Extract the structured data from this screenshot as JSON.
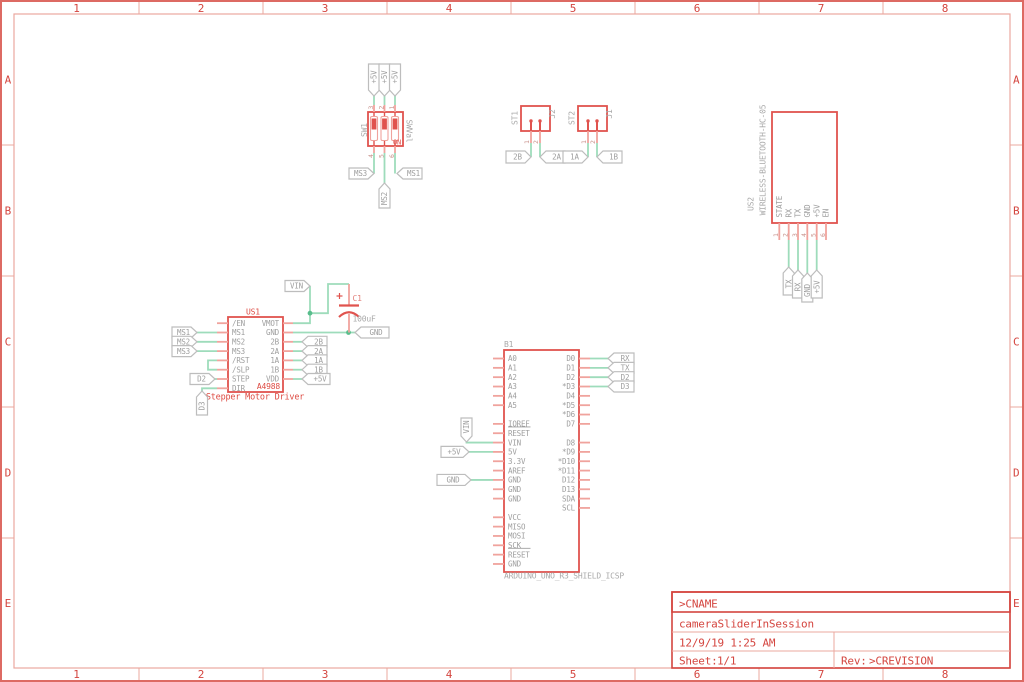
{
  "sheet": {
    "columns": [
      "1",
      "2",
      "3",
      "4",
      "5",
      "6",
      "7",
      "8"
    ],
    "rows": [
      "A",
      "B",
      "C",
      "D",
      "E"
    ]
  },
  "title_block": {
    "cname": ">CNAME",
    "project": "cameraSliderInSession",
    "datetime": "12/9/19 1:25 AM",
    "sheet_label": "Sheet:",
    "sheet_number": "1/1",
    "rev_label": "Rev:",
    "rev_value": ">CREVISION"
  },
  "dip_switch": {
    "name": "SW1",
    "value": "SWVal",
    "on_label": "ON",
    "top_pin_numbers": [
      "3",
      "2",
      "1"
    ],
    "bottom_pin_numbers": [
      "4",
      "5",
      "6"
    ],
    "top_flags": [
      "+5V",
      "+5V",
      "+5V"
    ],
    "bottom_flags": [
      "MS3",
      "MS2",
      "MS1"
    ]
  },
  "screw_terminal_1": {
    "name": "ST1",
    "value": "J2",
    "pin_numbers": [
      "1",
      "2"
    ],
    "flags": [
      "2B",
      "2A"
    ]
  },
  "screw_terminal_2": {
    "name": "ST2",
    "value": "J1",
    "pin_numbers": [
      "1",
      "2"
    ],
    "flags": [
      "1A",
      "1B"
    ]
  },
  "bluetooth": {
    "name": "US2",
    "value": "WIRELESS-BLUETOOTH-HC-05",
    "pins": [
      "STATE",
      "RX",
      "TX",
      "GND",
      "+5V",
      "EN"
    ],
    "pin_numbers": [
      "1",
      "2",
      "3",
      "4",
      "5",
      "6"
    ],
    "flags": [
      "TX",
      "RX",
      "GND",
      "+5V"
    ]
  },
  "stepper_driver": {
    "name": "US1",
    "value": "A4988",
    "caption": "Stepper Motor Driver",
    "pin_rows": [
      {
        "left": "/EN",
        "right": "VMOT"
      },
      {
        "left": "MS1",
        "right": "GND"
      },
      {
        "left": "MS2",
        "right": "2B"
      },
      {
        "left": "MS3",
        "right": "2A"
      },
      {
        "left": "/RST",
        "right": "1A"
      },
      {
        "left": "/SLP",
        "right": "1B"
      },
      {
        "left": "STEP",
        "right": "VDD"
      },
      {
        "left": "DIR",
        "right": ""
      }
    ],
    "left_flags": [
      "MS1",
      "MS2",
      "MS3"
    ],
    "step_flag": "D2",
    "dir_flag": "D3",
    "vin_flag": "VIN",
    "gnd_flag": "GND",
    "right_flags": [
      "2B",
      "2A",
      "1A",
      "1B",
      "+5V"
    ]
  },
  "capacitor": {
    "name": "C1",
    "value": "100uF",
    "polarity": "+"
  },
  "arduino": {
    "name": "B1",
    "value": "ARDUINO_UNO_R3_SHIELD_ICSP",
    "pin_rows": [
      {
        "left": "A0",
        "right": "D0"
      },
      {
        "left": "A1",
        "right": "D1"
      },
      {
        "left": "A2",
        "right": "D2"
      },
      {
        "left": "A3",
        "right": "*D3"
      },
      {
        "left": "A4",
        "right": "D4"
      },
      {
        "left": "A5",
        "right": "*D5"
      },
      {
        "left": "",
        "right": "*D6"
      },
      {
        "left": "IOREF",
        "right": "D7"
      },
      {
        "left": "RESET",
        "right": ""
      },
      {
        "left": "VIN",
        "right": "D8"
      },
      {
        "left": "5V",
        "right": "*D9"
      },
      {
        "left": "3.3V",
        "right": "*D10"
      },
      {
        "left": "AREF",
        "right": "*D11"
      },
      {
        "left": "GND",
        "right": "D12"
      },
      {
        "left": "GND",
        "right": "D13"
      },
      {
        "left": "GND",
        "right": "SDA"
      },
      {
        "left": "",
        "right": "SCL"
      },
      {
        "left": "VCC",
        "right": ""
      },
      {
        "left": "MISO",
        "right": ""
      },
      {
        "left": "MOSI",
        "right": ""
      },
      {
        "left": "SCK",
        "right": ""
      },
      {
        "left": "RESET",
        "right": ""
      },
      {
        "left": "GND",
        "right": ""
      }
    ],
    "vin_flag": "VIN",
    "v5_flag": "+5V",
    "gnd_flag": "GND",
    "serial_flags": [
      "RX",
      "TX",
      "D2",
      "D3"
    ]
  },
  "colors": {
    "component_red": "#e0534e",
    "pin_red": "#f0a39d",
    "wire_green": "#9edcbb",
    "junction_green": "#58bd8c",
    "flag_gray": "#bdbdbd",
    "label_gray": "#9e9e9e",
    "name_gray": "#a9a9a9",
    "pin_number": "#c9938d",
    "frame_red": "#dd6a63",
    "frame_light": "#eba89f",
    "title_red": "#d4453f"
  }
}
